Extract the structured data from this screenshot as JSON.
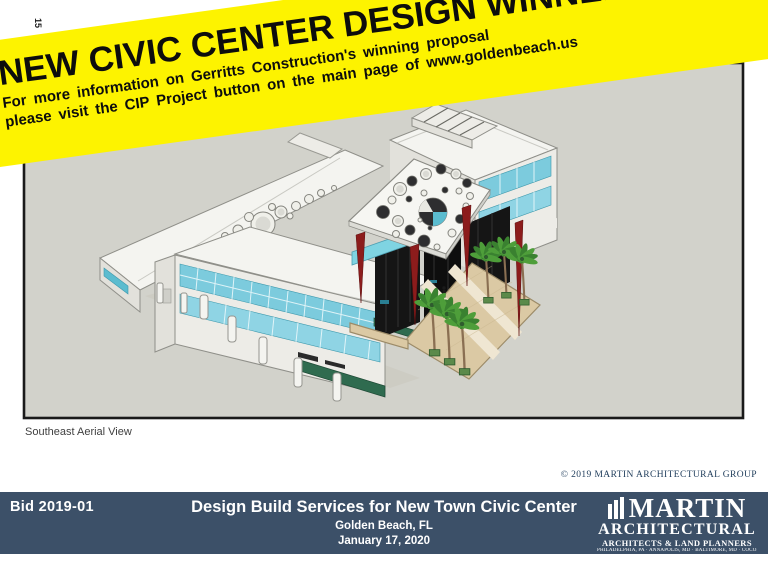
{
  "page_marker": "15",
  "banner": {
    "background": "#FDF300",
    "title": "NEW CIVIC CENTER DESIGN WINNER",
    "line1": "For more information on Gerritts Construction's winning proposal",
    "line2": "please visit the CIP Project button on the main page of www.goldenbeach.us"
  },
  "viewport": {
    "caption": "Southeast Aerial View",
    "background": "#D2D2CB",
    "border": "#1A1A1A"
  },
  "rendering_colors": {
    "building_white": "#F4F4F0",
    "glass_teal": "#7CCBDD",
    "entry_dark": "#151515",
    "fin_red": "#8C1C1C",
    "plaza_tan": "#DBC9A4",
    "palm_green": "#4E9E3A",
    "hedge_green": "#2F6B4F"
  },
  "copyright": "© 2019 MARTIN ARCHITECTURAL GROUP",
  "footer": {
    "bar_color": "#3C5068",
    "bid": "Bid 2019-01",
    "title": "Design Build Services for New Town Civic Center",
    "location": "Golden Beach, FL",
    "date": "January 17, 2020",
    "logo": {
      "name": "MARTIN",
      "subname": "ARCHITECTURAL",
      "tagline": "ARCHITECTS & LAND PLANNERS",
      "cities": "PHILADELPHIA, PA · ANNAPOLIS, MD · BALTIMORE, MD · COCONUT CREEK, FL"
    }
  }
}
